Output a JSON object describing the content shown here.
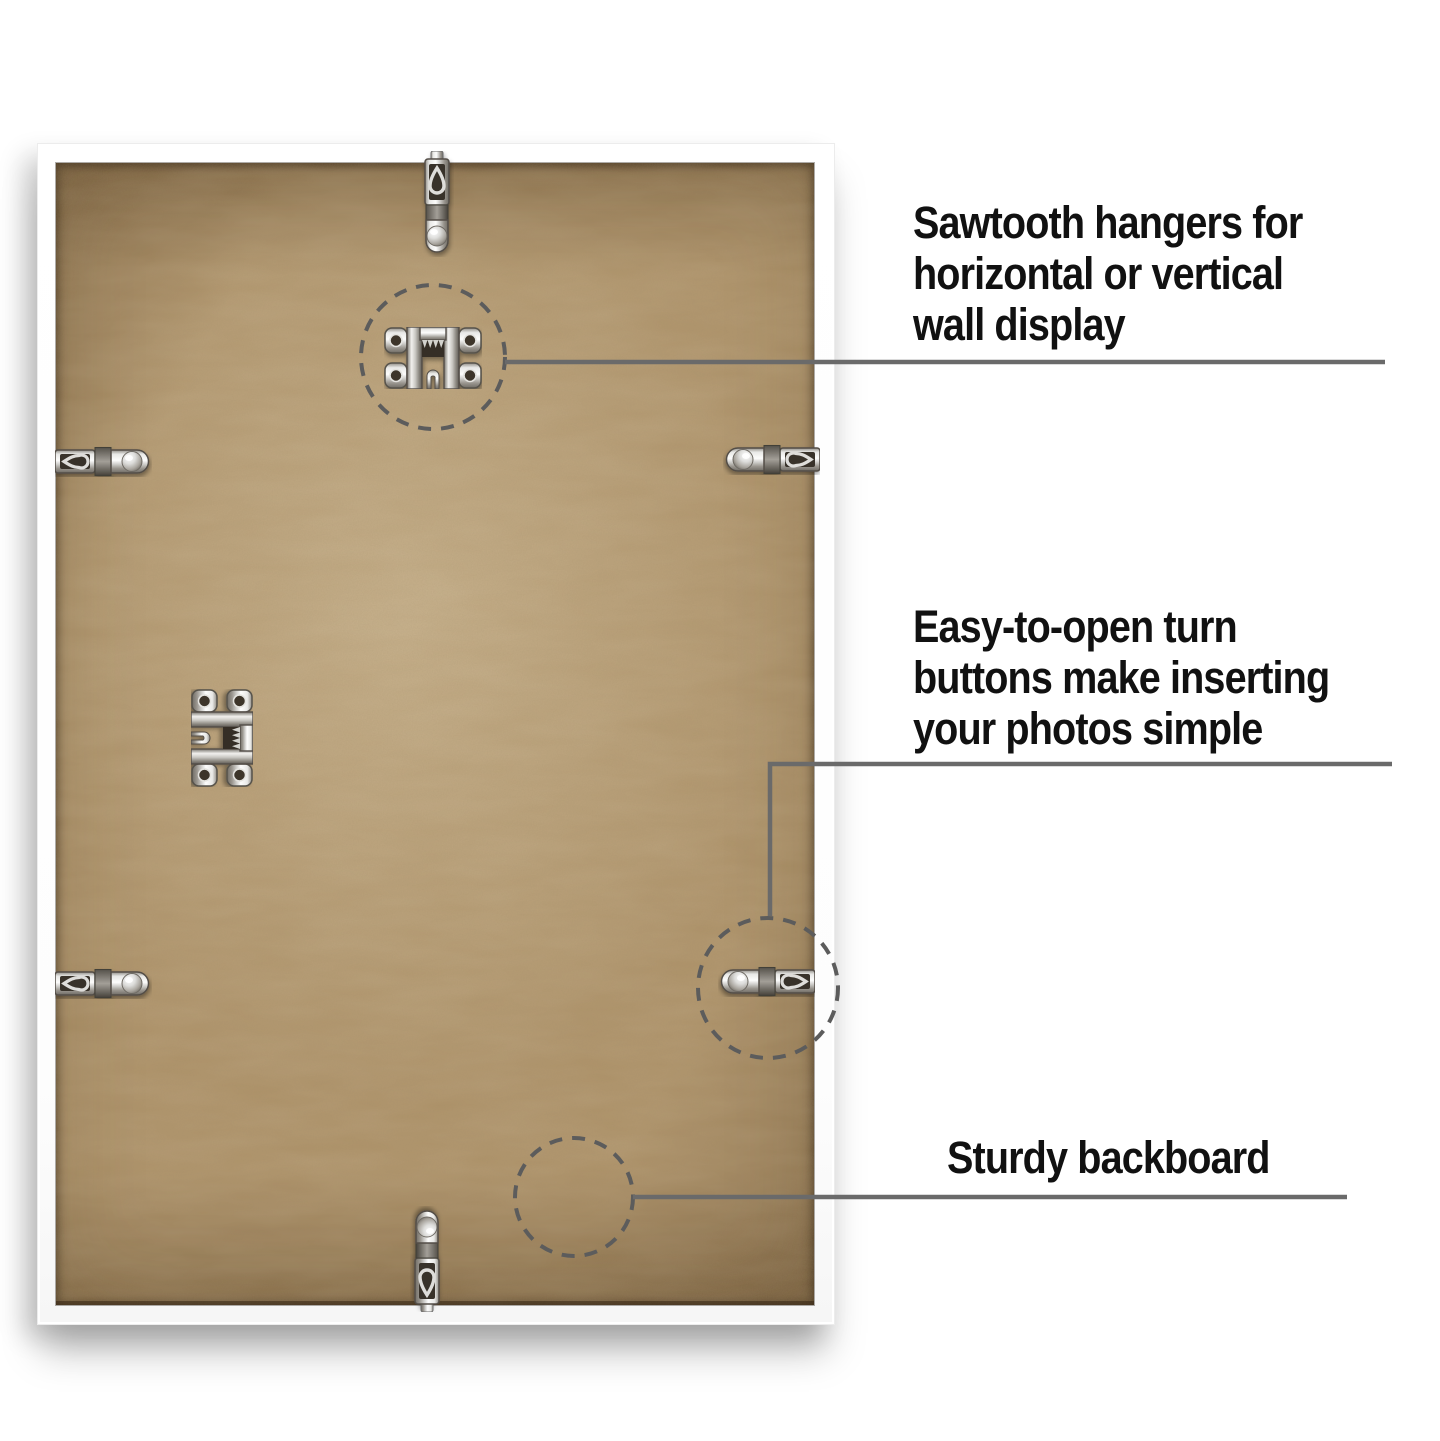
{
  "scene": {
    "description": "Back view of a white picture frame showing hanging hardware",
    "background": "#ffffff"
  },
  "frame": {
    "frame_color": "#ffffff",
    "backboard_color": "#ad9168"
  },
  "annotations": [
    {
      "id": "sawtooth-hangers",
      "lines": [
        "Sawtooth hangers for",
        "horizontal or vertical",
        "wall display"
      ]
    },
    {
      "id": "turn-buttons",
      "lines": [
        "Easy-to-open turn",
        "buttons make inserting",
        "your photos simple"
      ]
    },
    {
      "id": "sturdy-backboard",
      "lines": [
        "Sturdy backboard"
      ]
    }
  ],
  "icons": {
    "hanger_tab_top": "hanger-tab-icon",
    "hanger_tab_bottom": "hanger-tab-icon",
    "sawtooth_hanger": "sawtooth-hanger-icon",
    "sawtooth_hanger_center": "sawtooth-hanger-icon",
    "turn_button_top_left": "turn-button-icon",
    "turn_button_top_right": "turn-button-icon",
    "turn_button_bottom_left": "turn-button-icon",
    "turn_button_bottom_right": "turn-button-icon"
  },
  "colors": {
    "text": "#111111",
    "leader_line": "#6a6a6a",
    "dashed_circle": "#5c5c5c",
    "metal_light": "#f2f1ee",
    "metal_dark": "#6f6b64"
  }
}
